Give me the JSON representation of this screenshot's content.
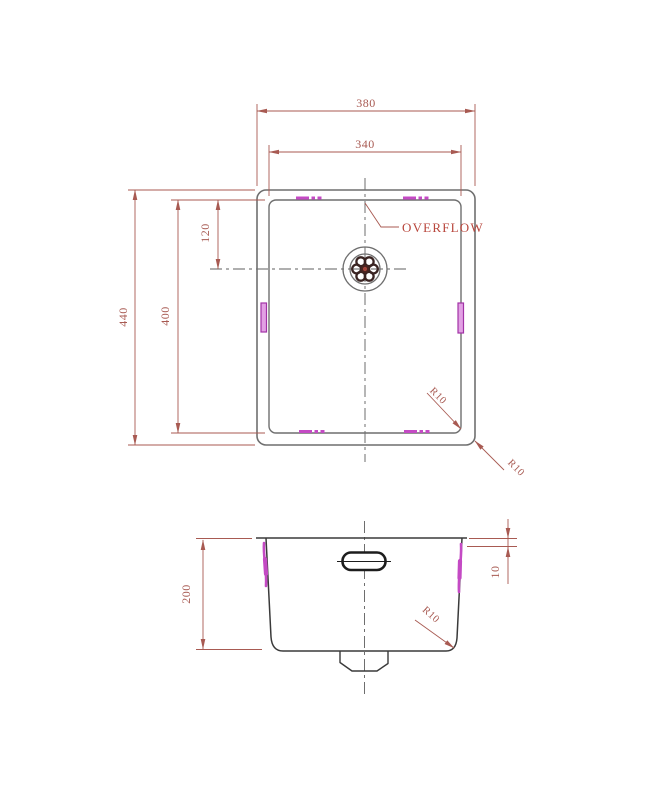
{
  "drawing_type": "sink-technical-drawing",
  "top_view": {
    "dim_outer_width": "380",
    "dim_inner_width": "340",
    "dim_outer_height": "440",
    "dim_inner_height": "400",
    "dim_drain_offset": "120",
    "overflow_label": "OVERFLOW",
    "radius_inner_corner": "R10",
    "radius_outer_corner": "R10"
  },
  "side_view": {
    "dim_depth": "200",
    "dim_rim": "10",
    "radius_bottom_corner": "R10"
  },
  "colors": {
    "background": "#ffffff",
    "outline": "#6f6f6f",
    "outline_dark": "#3a3a3a",
    "centerline": "#5f5f5f",
    "dim_line": "#a85a52",
    "overflow_text": "#b8463c",
    "accent_magenta": "#c44ac4",
    "accent_magenta_fill": "#e2a0e4",
    "accent_magenta_dark": "#a232a6",
    "drain_dark": "#3a2422"
  }
}
